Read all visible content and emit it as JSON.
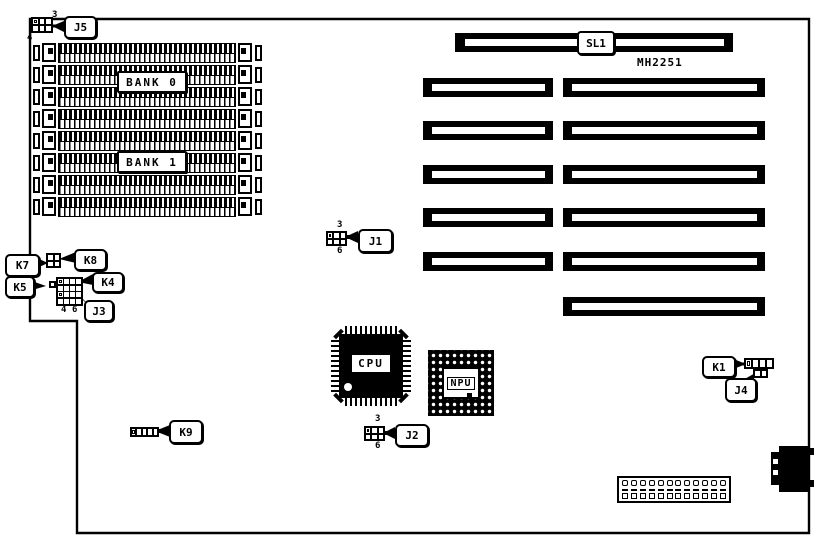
{
  "board": {
    "part_number": "MH2251",
    "bank0": "BANK 0",
    "bank1": "BANK 1",
    "sl1": "SL1",
    "cpu": "CPU",
    "npu": "NPU",
    "j1": {
      "label": "J1",
      "top": "3",
      "bottom": "6"
    },
    "j2": {
      "label": "J2",
      "top": "3",
      "bottom": "6"
    },
    "j3": {
      "label": "J3",
      "left": "4",
      "right": "6"
    },
    "j4": "J4",
    "j5": {
      "label": "J5",
      "top": "3",
      "bottom": "4"
    },
    "k1": "K1",
    "k4": "K4",
    "k5": "K5",
    "k7": "K7",
    "k8": "K8",
    "k9": "K9"
  }
}
